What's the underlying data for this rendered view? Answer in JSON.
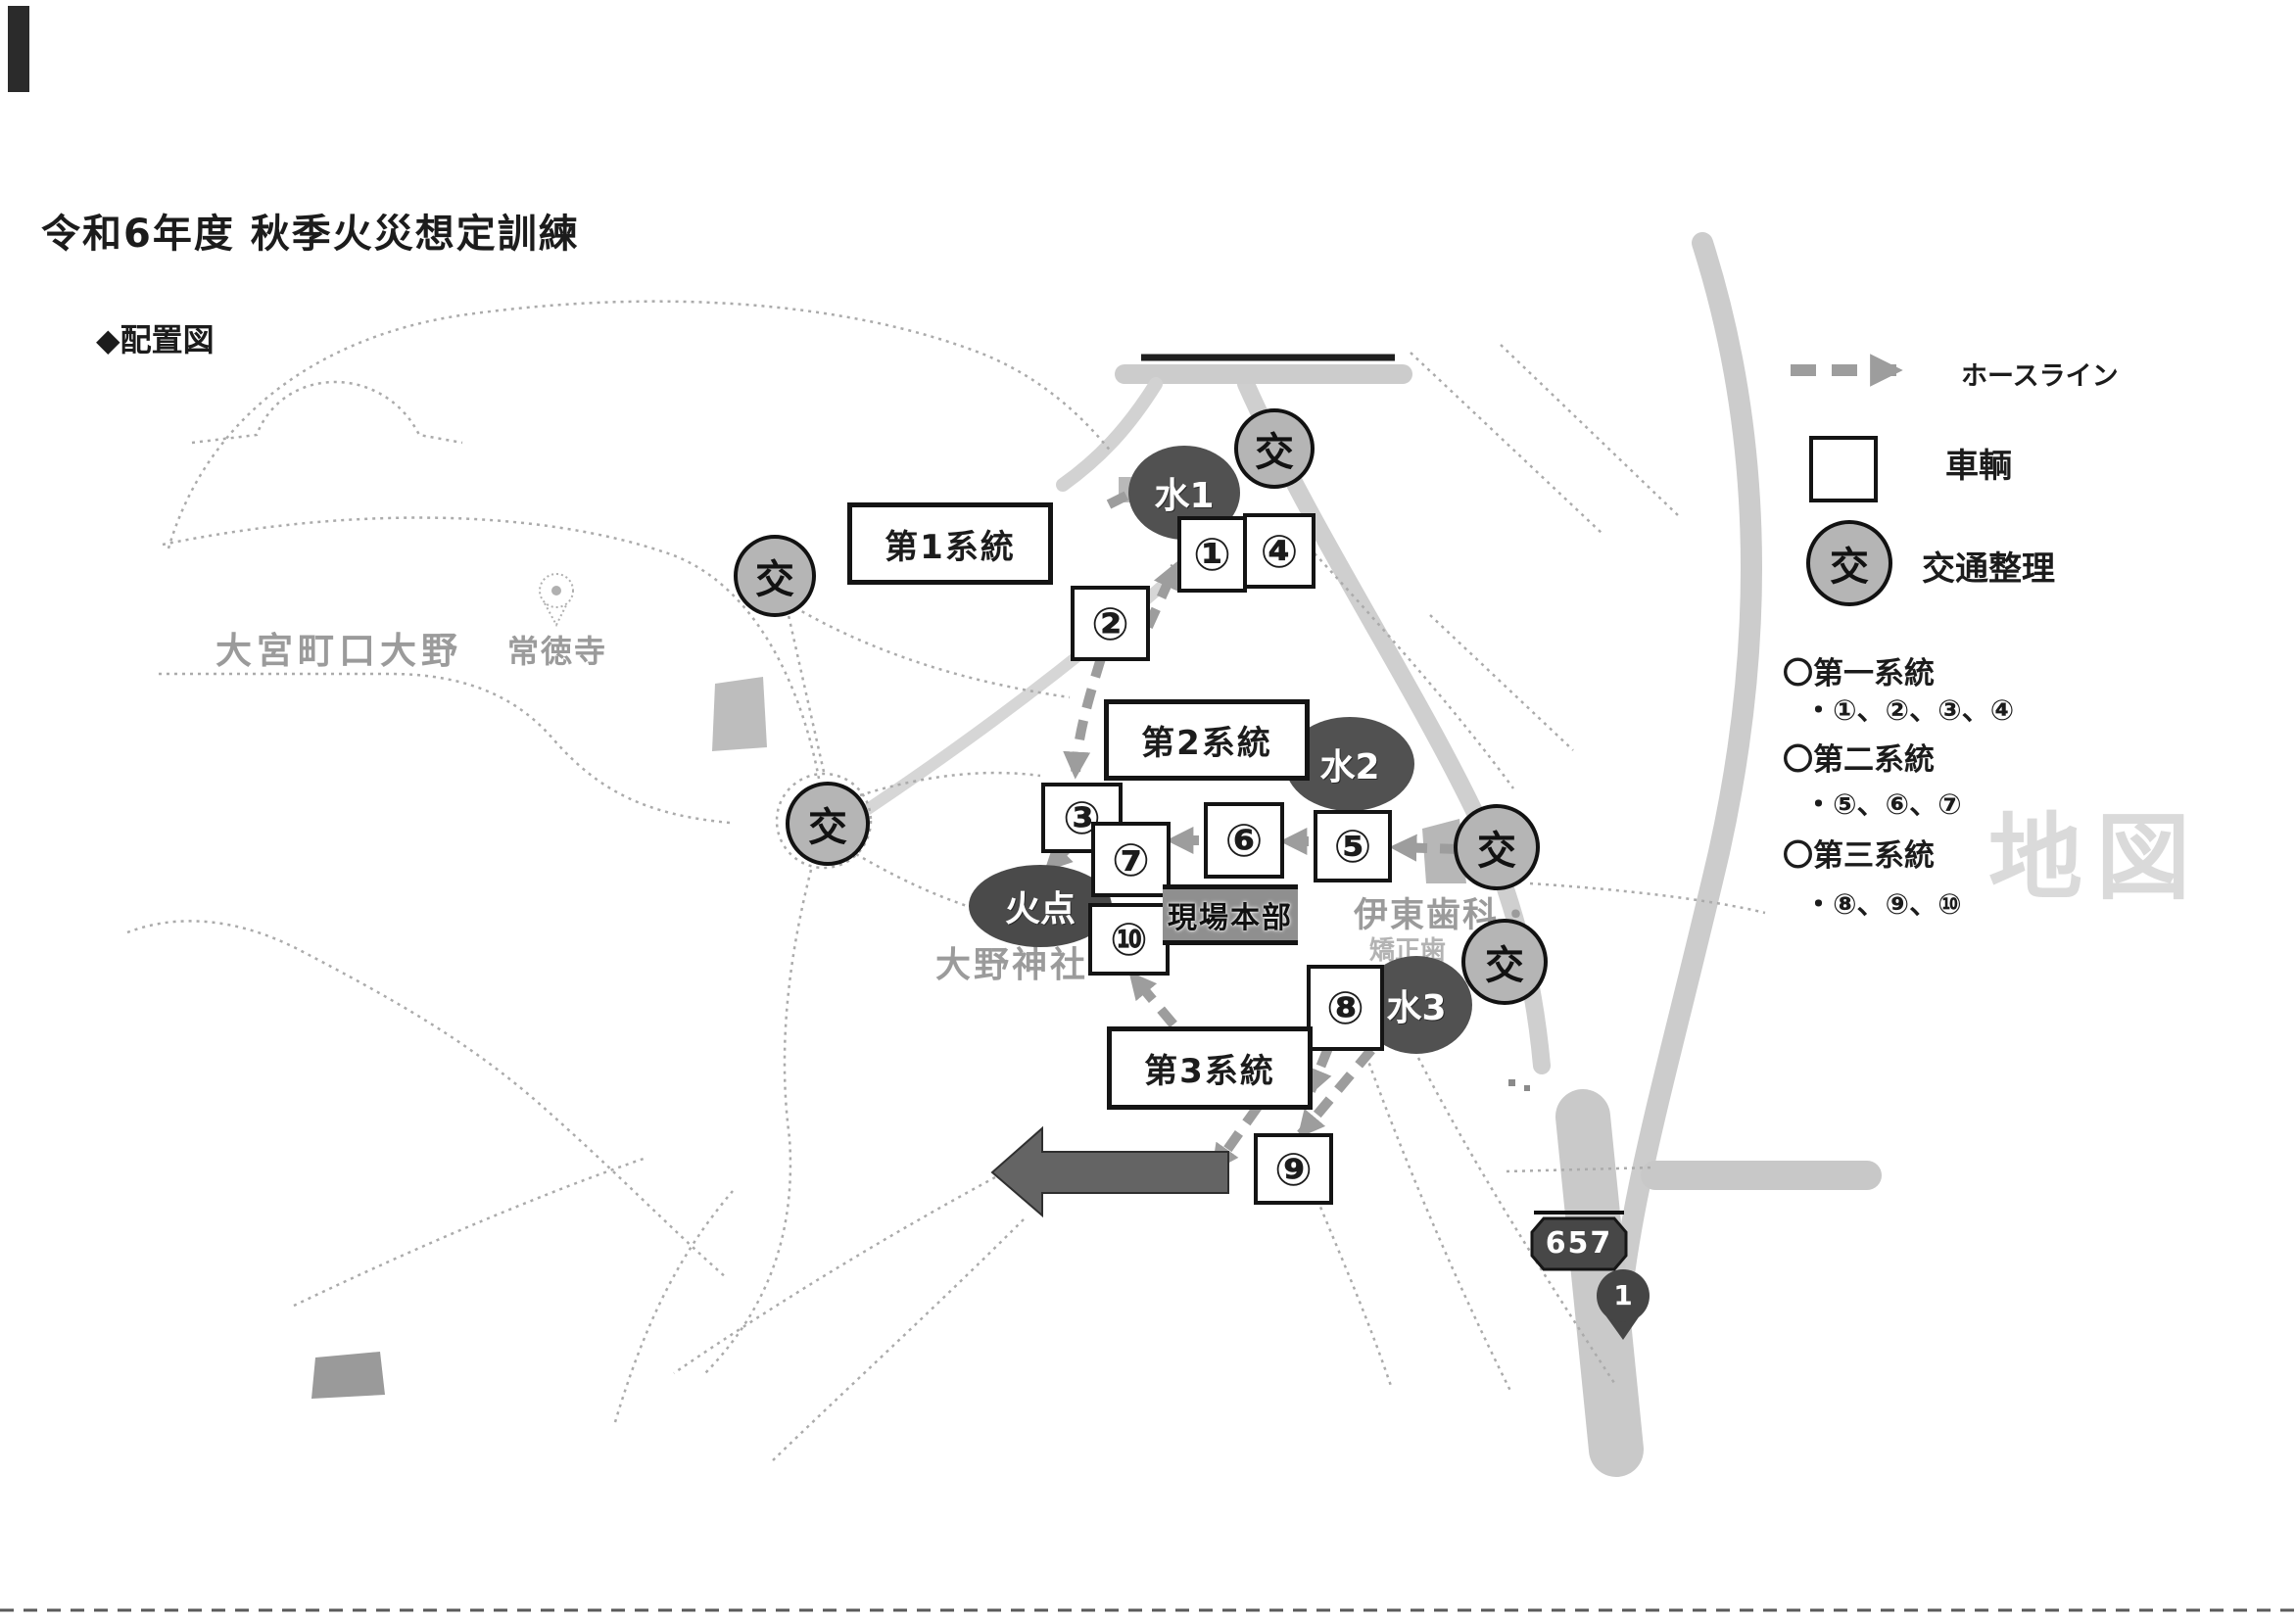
{
  "title": "令和6年度 秋季火災想定訓練",
  "section_heading": "◆配置図",
  "legend": {
    "hose_line_label": "ホースライン",
    "vehicle_label": "車輌",
    "traffic_control_label": "交通整理",
    "traffic_symbol": "交"
  },
  "systems_list": [
    {
      "name": "〇第一系統",
      "units": "・①、②、③、④"
    },
    {
      "name": "〇第二系統",
      "units": "・⑤、⑥、⑦"
    },
    {
      "name": "〇第三系統",
      "units": "・⑧、⑨、⑩"
    }
  ],
  "map_labels": {
    "district": "大宮町口大野",
    "temple": "常徳寺",
    "shrine": "大野神社",
    "dental_clinic": "伊東歯科・",
    "dental_clinic_line2": "矯正歯",
    "watermark": "地図",
    "route_number": "657",
    "map_pin_number": "1"
  },
  "overlay": {
    "system1_box": "第1系統",
    "system2_box": "第2系統",
    "system3_box": "第3系統",
    "hq_box": "現場本部",
    "fire_point": "火点",
    "water1": "水1",
    "water2": "水2",
    "water3": "水3",
    "traffic_symbol": "交",
    "vehicle_numbers": [
      "①",
      "②",
      "③",
      "④",
      "⑤",
      "⑥",
      "⑦",
      "⑧",
      "⑨",
      "⑩"
    ]
  },
  "colors": {
    "ink": "#1c1c1c",
    "water_fill": "#515151",
    "traffic_fill": "#b5b5b5",
    "hose_gray": "#9d9d9d",
    "road_gray": "#c9c9c9",
    "faded_label": "#9b9b9b",
    "hq_fill": "#8f8f8f",
    "big_arrow_fill": "#646464"
  }
}
